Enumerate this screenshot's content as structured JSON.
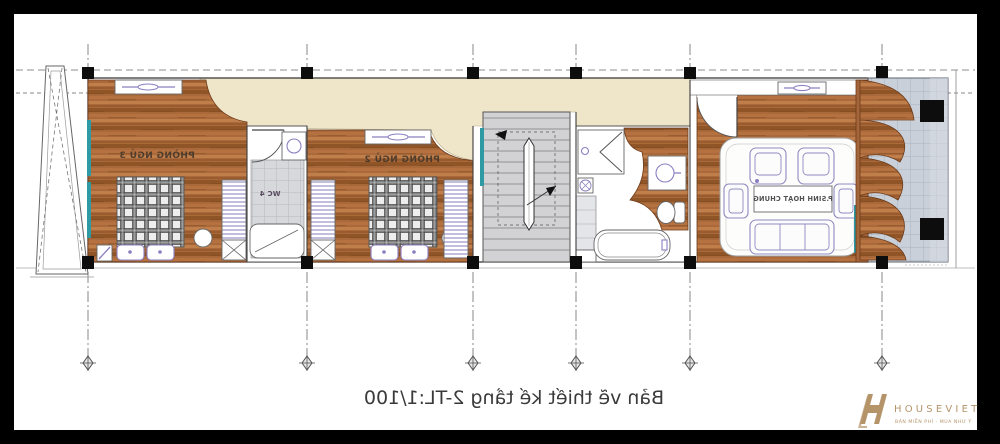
{
  "drawing": {
    "plan_title": "Bản vẽ thiết kế tầng 2-TL:1/100",
    "rooms": {
      "bedroom3": {
        "label": "PHÒNG NGỦ 3"
      },
      "bedroom2": {
        "label": "PHÒNG NGỦ 2"
      },
      "wc4": {
        "label": "WC 4"
      },
      "living": {
        "label": "P.SINH HOẠT CHUNG"
      }
    }
  },
  "watermark": {
    "brand": "HOUSEVIET",
    "tagline": "BÁN MIỄN PHÍ - MUA NHƯ Ý"
  },
  "colors": {
    "wood": "#a9693a",
    "wood_dark": "#8f5527",
    "wood_mid": "#b5713f",
    "wood_light": "#c07f4a",
    "beige": "#efe5c9",
    "tile": "#d6d8dc",
    "stair": "#d2d2d5",
    "balcony": "#c9d0d9",
    "teal": "#2f9aa3",
    "fixture_purple": "#8b7fc1",
    "frame_black": "#000000",
    "logo_gold": "#b5946a",
    "line_dark": "#3c3c3c",
    "title_text": "#3a3a3a"
  }
}
